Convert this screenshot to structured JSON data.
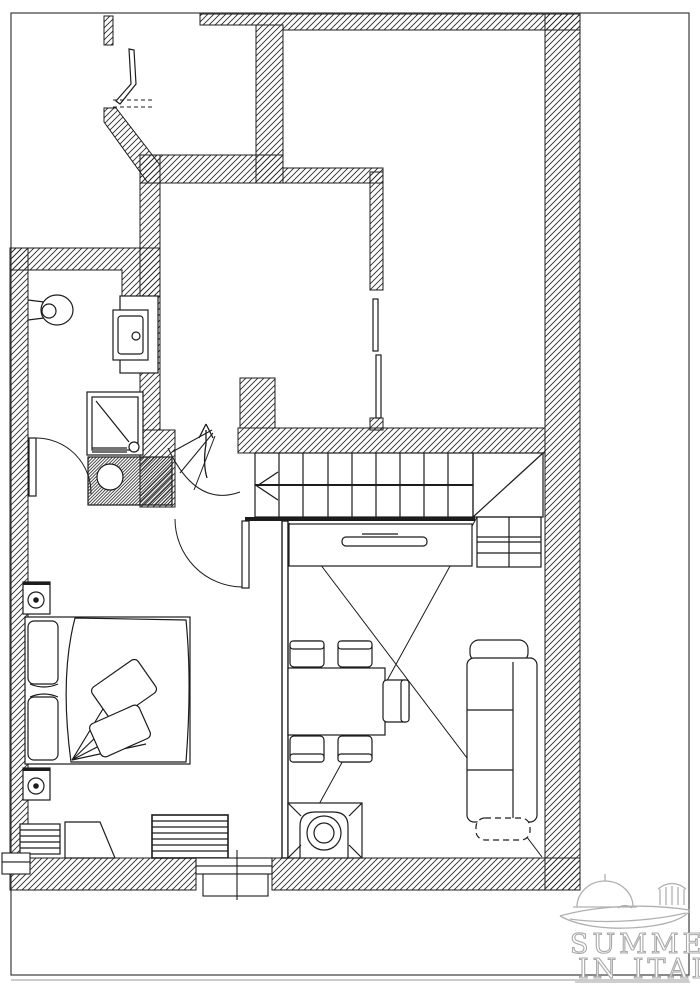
{
  "page": {
    "type": "apartment-floor-plan",
    "background": "#ffffff",
    "ink": "#1c1c1c",
    "watermark_color": "#aaaaaa"
  },
  "watermark": {
    "line1": "SUMMER",
    "line2": "IN ITALY"
  },
  "fixtures": [
    "toilet",
    "sink",
    "shower",
    "washbasin-column",
    "double-bed",
    "nightstand-lamps",
    "wardrobe",
    "dresser",
    "radiator",
    "dining-table",
    "dining-chairs",
    "sofa",
    "stove",
    "straight-stair",
    "winder-stair",
    "under-stair-cupboard",
    "double-door",
    "window",
    "door-swings",
    "up-arrow",
    "direction-arrow"
  ]
}
